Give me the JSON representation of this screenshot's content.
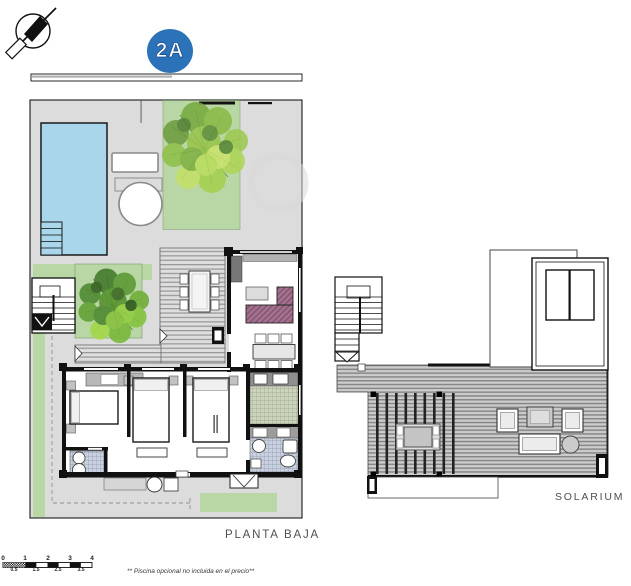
{
  "badge": {
    "label": "2A"
  },
  "labels": {
    "ground_floor": "PLANTA BAJA",
    "solarium": "SOLARIUM"
  },
  "footnote": "** Piscina opcional no incluida en el precio**",
  "scale_bar": {
    "top_labels": [
      "0",
      "1",
      "2",
      "3",
      "4"
    ],
    "bottom_labels": [
      "0.5",
      "1.5",
      "2.5",
      "3.5"
    ]
  },
  "icons": [
    "north-arrow-icon",
    "tree-symbol",
    "bush-symbol"
  ],
  "colors": {
    "badge": "#2c72b8",
    "pool": "#a9d6eb",
    "grass": "#b9d7a4",
    "terrace": "#dcdcdc",
    "sofa": "#a4718e",
    "wall": "#111111"
  }
}
